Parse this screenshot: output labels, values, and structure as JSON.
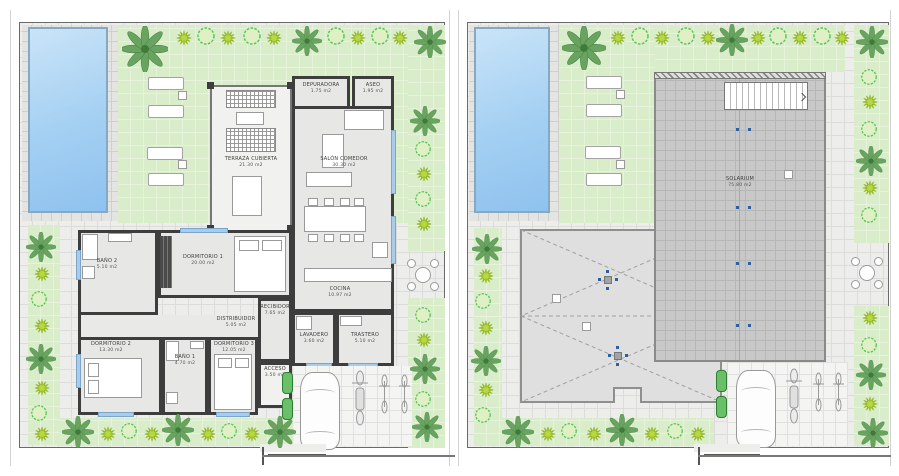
{
  "document": {
    "type": "architectural floor plan, two panels",
    "left_panel_name": "ground floor site plan",
    "right_panel_name": "roof / solarium site plan"
  },
  "panels": {
    "left": {
      "rooms": {
        "depuradora": {
          "name": "DEPURADORA",
          "area": "1.75 m2"
        },
        "aseo": {
          "name": "ASEO",
          "area": "1.95 m2"
        },
        "terraza": {
          "name": "TERRAZA CUBIERTA",
          "area": "21.30 m2"
        },
        "salon": {
          "name": "SALÓN COMEDOR",
          "area": "30.30 m2"
        },
        "cocina": {
          "name": "COCINA",
          "area": "10.97 m2"
        },
        "dorm1": {
          "name": "DORMITORIO 1",
          "area": "20.00 m2"
        },
        "bano2": {
          "name": "BAÑO 2",
          "area": "5.10 m2"
        },
        "distribuidor": {
          "name": "DISTRIBUIDOR",
          "area": "5.05 m2"
        },
        "dorm2": {
          "name": "DORMITORIO 2",
          "area": "13.30 m2"
        },
        "bano1": {
          "name": "BAÑO 1",
          "area": "4.70 m2"
        },
        "dorm3": {
          "name": "DORMITORIO 3",
          "area": "12.05 m2"
        },
        "recibidor": {
          "name": "RECIBIDOR",
          "area": "7.65 m2"
        },
        "lavadero": {
          "name": "LAVADERO",
          "area": "3.60 m2"
        },
        "trastero": {
          "name": "TRASTERO",
          "area": "5.10 m2"
        },
        "acceso": {
          "name": "ACCESO",
          "area": "3.50 m2"
        }
      }
    },
    "right": {
      "rooms": {
        "solarium": {
          "name": "SOLARIUM",
          "area": "75.80 m2"
        }
      }
    }
  },
  "colors": {
    "lawn": "#d9edca",
    "paving": "#ededeb",
    "pool_water": "#9ccbf0",
    "pool_border": "#86a8c0",
    "wall": "#3d3d3d",
    "interior_floor": "#e7e7e5",
    "solarium_deck": "#c8c8c8",
    "roof": "#dfdfdf",
    "window": "#a9cceb",
    "palm_green": "#5f9e58",
    "bush_bright": "#b5d93e",
    "bush_outline": "#54c254",
    "entry_door_green": "#6abf69",
    "drain_dot_blue": "#2e5fa3"
  }
}
